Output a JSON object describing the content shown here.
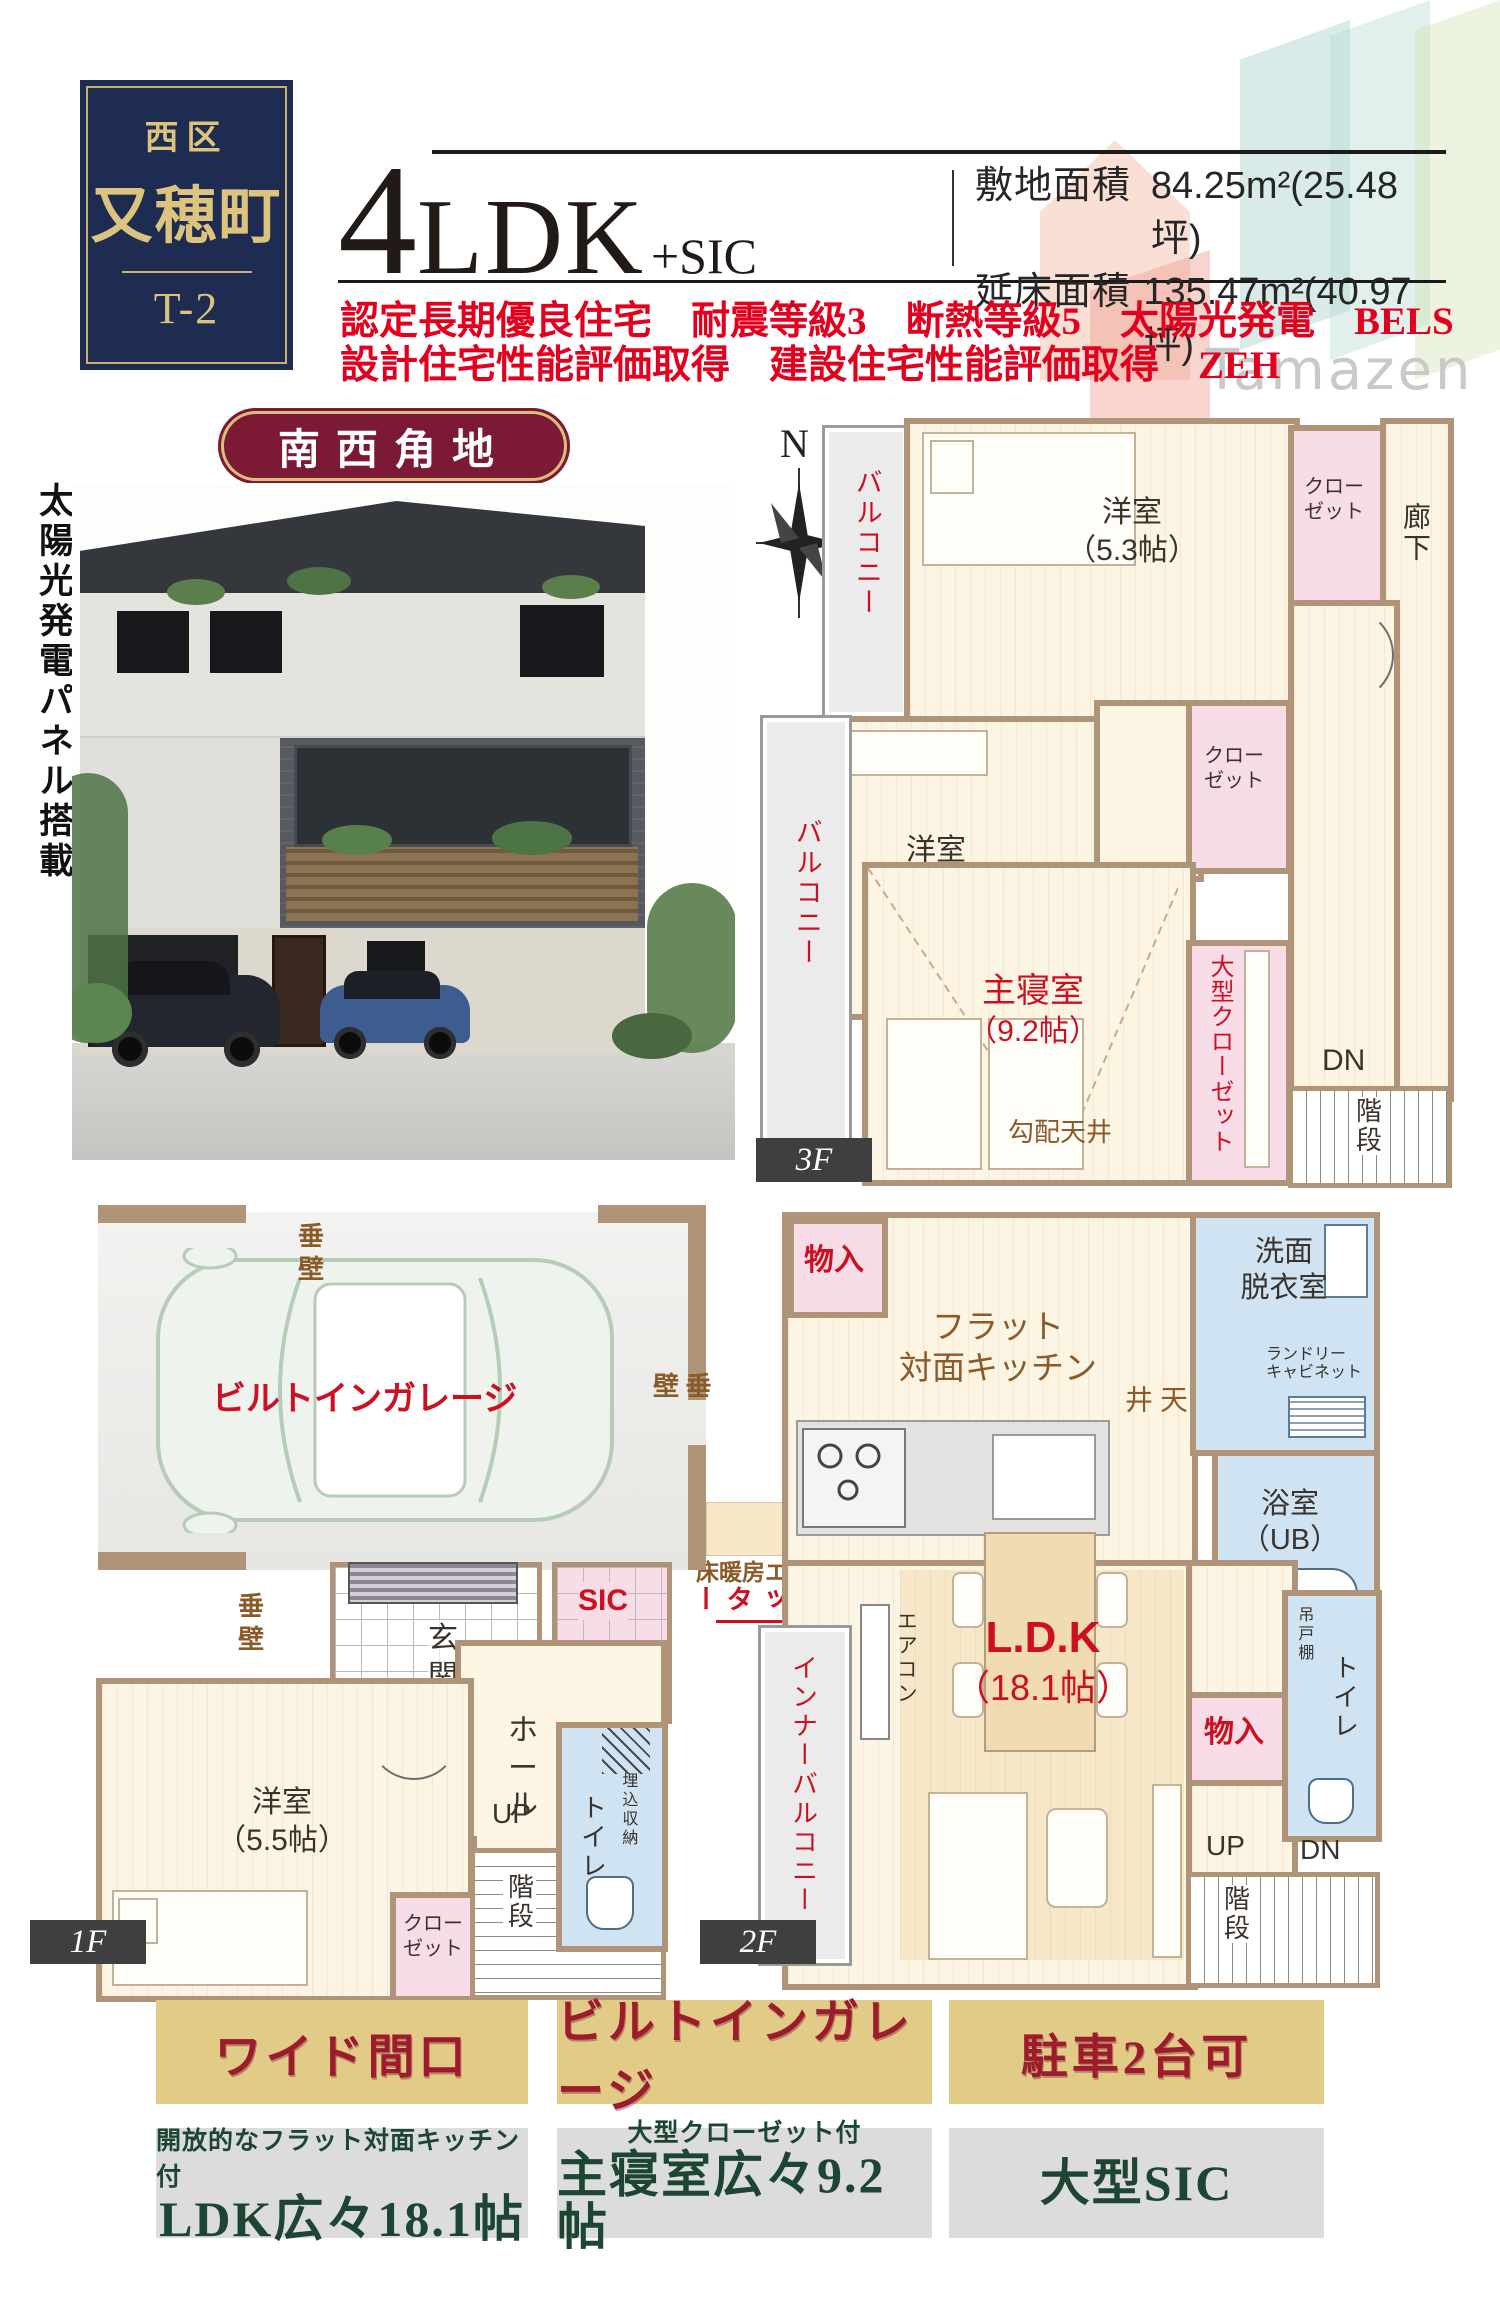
{
  "header": {
    "district": "西区",
    "town": "又穂町",
    "unit": "T-2",
    "layout_big": "4",
    "layout_rest": "LDK",
    "layout_suffix": "+SIC",
    "site_area_label": "敷地面積",
    "site_area_value": "84.25m²(25.48坪)",
    "floor_area_label": "延床面積",
    "floor_area_value": "135.47m²(40.97坪)",
    "features_line1": "認定長期優良住宅　耐震等級3　断熱等級5　太陽光発電　BELS",
    "features_line2": "設計住宅性能評価取得　建設住宅性能評価取得　ZEH",
    "watermark": "Tamazen"
  },
  "corner_badge": "南西角地",
  "solar_note": "太陽光発電パネル搭載",
  "colors": {
    "navy": "#1d2c50",
    "gold": "#c9b070",
    "feature_red": "#e3001e",
    "maroon_badge": "#7c1a35",
    "plan_red": "#cc1022",
    "plan_brown": "#8a5a28",
    "badge_gold_bg": "#e2ca87",
    "badge_text_red": "#9e1b2e",
    "highlight_green": "#1c4633"
  },
  "floor3": {
    "label": "3F",
    "compass_n": "N",
    "balcony_upper": "バルコニー",
    "balcony_lower": "バルコニー",
    "room1_name": "洋室",
    "room1_size": "（5.3帖）",
    "closet1_l1": "クロー",
    "closet1_l2": "ゼット",
    "hallway": "廊下",
    "room2_name": "洋室",
    "room2_size": "（5.5帖）",
    "closet2_l1": "クロー",
    "closet2_l2": "ゼット",
    "master_name": "主寝室",
    "master_size": "（9.2帖）",
    "sloped_ceiling": "勾配天井",
    "big_closet": "大型クローゼット",
    "dn": "DN",
    "stairs": "階段"
  },
  "floor2": {
    "label": "2F",
    "storage_top": "物入",
    "kitchen_l1": "フラット",
    "kitchen_l2": "対面キッチン",
    "lowered_ceiling": "折下天井",
    "washroom_l1": "洗面",
    "washroom_l2": "脱衣室",
    "laundry_l1": "ランドリー",
    "laundry_l2": "キャビネット",
    "bath_l1": "浴室",
    "bath_l2": "（UB）",
    "floor_heating": "床暖房エリア",
    "shutter": "電動シャッター",
    "aircon": "エアコン",
    "ldk_name": "L.D.K",
    "ldk_size": "（18.1帖）",
    "inner_balcony": "インナーバルコニー",
    "storage_bottom": "物入",
    "hanging_shelf": "吊戸棚",
    "toilet": "トイレ",
    "hallway": "廊下",
    "up": "UP",
    "dn": "DN",
    "stairs": "階段"
  },
  "floor1": {
    "label": "1F",
    "garage": "ビルトインガレージ",
    "tarekabe_top": "垂壁",
    "tarekabe_right": "垂壁",
    "tarekabe_bottom": "垂壁",
    "entrance": "玄関",
    "sic": "SIC",
    "hall": "ホール",
    "vanity_l1": "洗面",
    "vanity_l2": "化粧台",
    "up": "UP",
    "room_name": "洋室",
    "room_size": "（5.5帖）",
    "closet_l1": "クロー",
    "closet_l2": "ゼット",
    "stairs": "階段",
    "toilet": "トイレ",
    "built_in_l1": "埋込",
    "built_in_l2": "収納"
  },
  "footer": {
    "badges": [
      "ワイド間口",
      "ビルトインガレージ",
      "駐車2台可"
    ],
    "highlights": [
      {
        "sub": "開放的なフラット対面キッチン付",
        "main": "LDK広々18.1帖"
      },
      {
        "sub": "大型クローゼット付",
        "main": "主寝室広々9.2帖"
      },
      {
        "sub": "",
        "main": "大型SIC"
      }
    ]
  }
}
